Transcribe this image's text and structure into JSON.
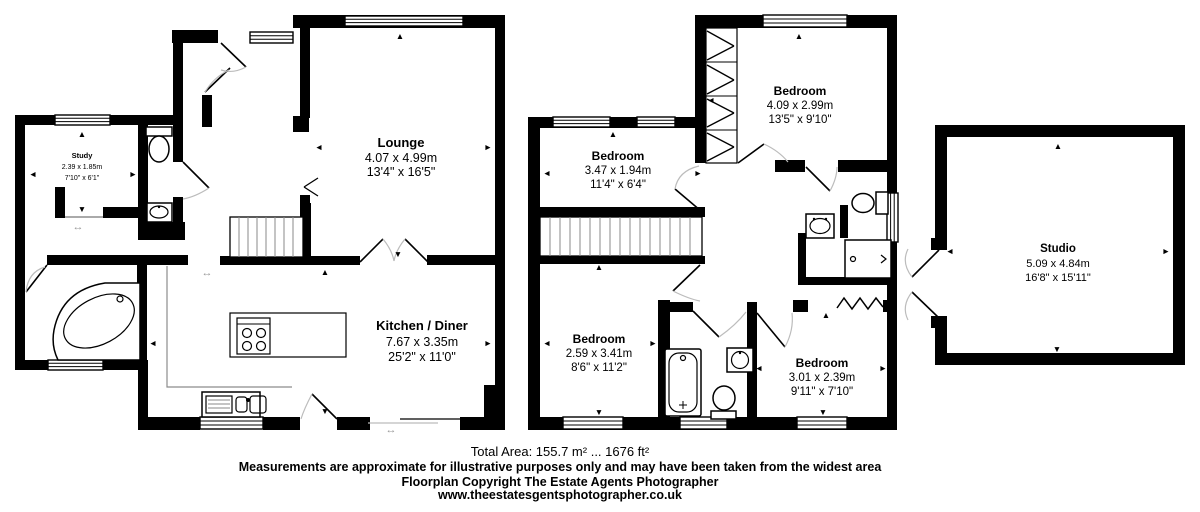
{
  "title": "Floorplan",
  "colors": {
    "wall": "#000000",
    "background": "#ffffff",
    "door_arc": "#bcbcbc"
  },
  "icons": {
    "up": "▲",
    "down": "▼",
    "left": "◄",
    "right": "►",
    "double_h": "↔"
  },
  "rooms": {
    "study": {
      "name": "Study",
      "metric": "2.39 x 1.85m",
      "imperial": "7'10\" x 6'1\""
    },
    "lounge": {
      "name": "Lounge",
      "metric": "4.07 x 4.99m",
      "imperial": "13'4\" x 16'5\""
    },
    "kitchen": {
      "name": "Kitchen / Diner",
      "metric": "7.67 x 3.35m",
      "imperial": "25'2\" x 11'0\""
    },
    "bedroom1": {
      "name": "Bedroom",
      "metric": "3.47 x 1.94m",
      "imperial": "11'4\" x 6'4\""
    },
    "bedroom2": {
      "name": "Bedroom",
      "metric": "4.09 x 2.99m",
      "imperial": "13'5\" x 9'10\""
    },
    "bedroom3": {
      "name": "Bedroom",
      "metric": "2.59 x 3.41m",
      "imperial": "8'6\" x 11'2\""
    },
    "bedroom4": {
      "name": "Bedroom",
      "metric": "3.01 x 2.39m",
      "imperial": "9'11\" x 7'10\""
    },
    "studio": {
      "name": "Studio",
      "metric": "5.09 x 4.84m",
      "imperial": "16'8\" x 15'11\""
    }
  },
  "footer": {
    "total_area": "Total Area: 155.7 m² ... 1676 ft²",
    "disclaimer": "Measurements are approximate for illustrative purposes only and may have been taken from the widest area",
    "copyright": "Floorplan Copyright The Estate Agents Photographer",
    "website": "www.theestatesgentsphotographer.co.uk"
  }
}
